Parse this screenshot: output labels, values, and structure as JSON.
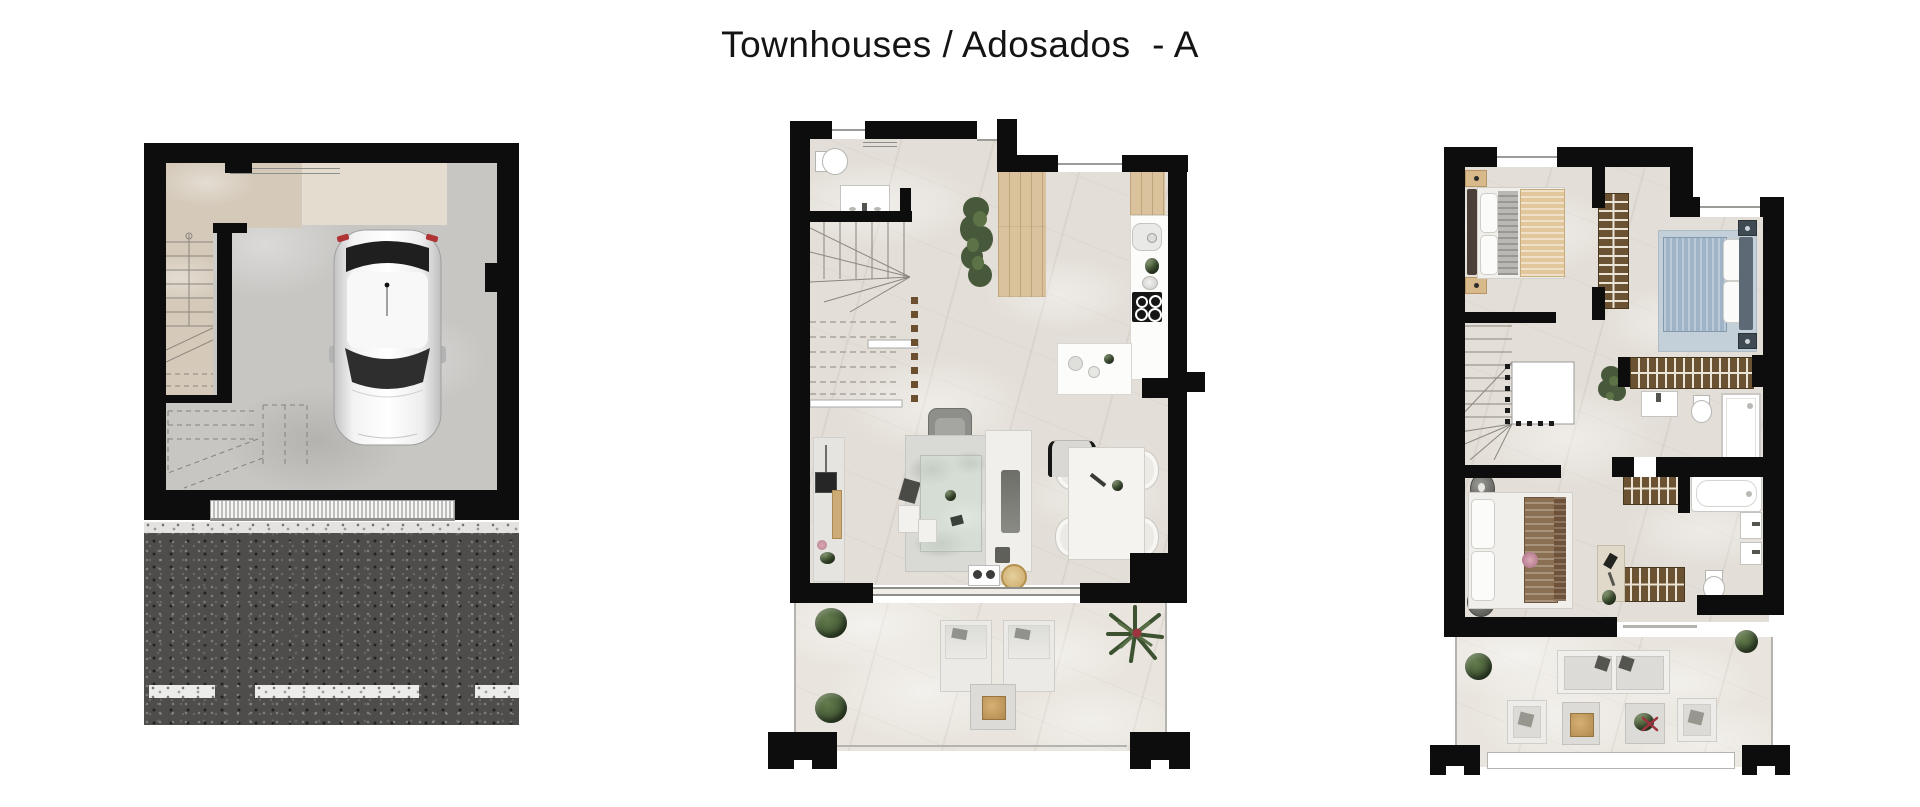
{
  "title": "Townhouses / Adosados  - A",
  "colors": {
    "wall": "#0d0d0d",
    "floor": "#e3ded7",
    "floor-light": "#e9e5de",
    "concrete": "#c7c6c3",
    "tan": "#d5caba",
    "tan-light": "#e3dccf",
    "asphalt": "#4e4d4b",
    "wood": "#d9c29c",
    "wardrobe": "#6b5233",
    "rung": "#ece4d6",
    "bed-tan": "#e2c79c",
    "bed-blue": "#9fb4c6",
    "rug-blue": "#c3cfd9",
    "furn-white": "#f0efeb",
    "blanket-brown": "#8b6f52",
    "green-dark": "#3f5431",
    "green": "#5a7047",
    "accent-red": "#9c3540",
    "line": "#8b867e"
  }
}
